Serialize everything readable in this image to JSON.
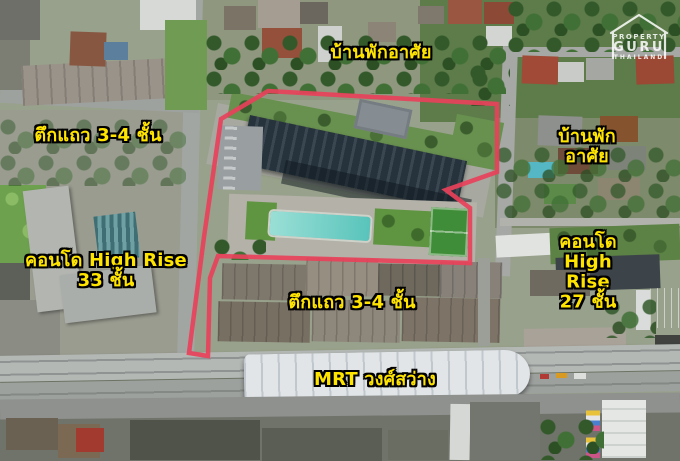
{
  "canvas": {
    "width": 680,
    "height": 461
  },
  "colors": {
    "label_fill": "#ffe400",
    "label_outline": "#000000",
    "site_outline": "#e8415a",
    "watermark": "#ffffff",
    "pool": "#5cc4bb",
    "football_field": "#3f8d38"
  },
  "labels": {
    "residential_top": "บ้านพักอาศัย",
    "shophouse_left": "ตึกแถว 3-4 ชั้น",
    "residential_right": "บ้านพักอาศัย",
    "condo_left": "คอนโด High Rise\n33 ชั้น",
    "condo_right": "คอนโด High Rise\n27 ชั้น",
    "shophouse_center": "ตึกแถว 3-4 ชั้น",
    "mrt_station": "MRT วงศ์สว่าง"
  },
  "watermark": {
    "line1": "PROPERTY",
    "line2": "GURU",
    "line3": "THAILAND"
  }
}
